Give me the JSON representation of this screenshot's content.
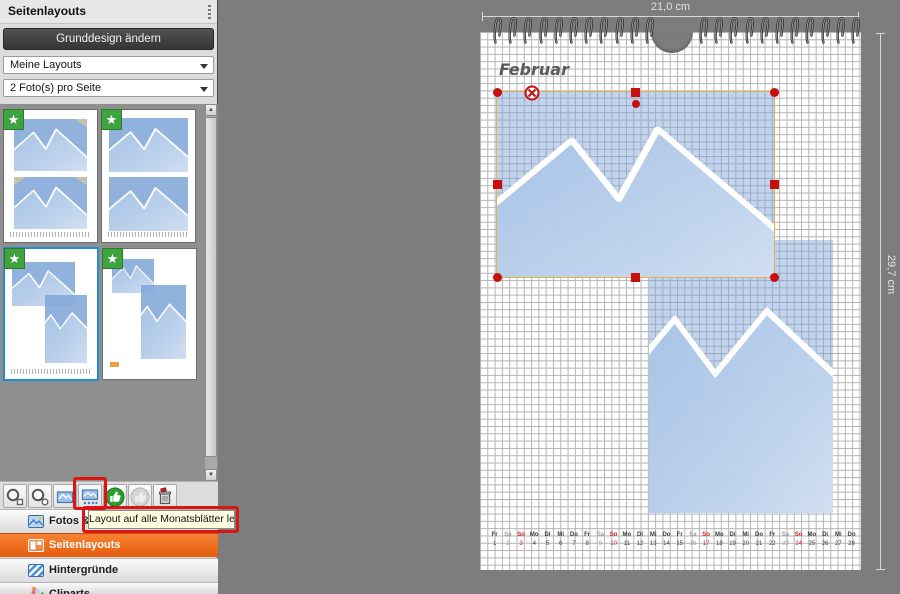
{
  "sidebar": {
    "title": "Seitenlayouts",
    "change_design_button": "Grunddesign ändern",
    "layout_group_value": "Meine Layouts",
    "photos_per_page_value": "2 Foto(s) pro Seite",
    "thumbnails": [
      {
        "name": "two-landscape-photos-with-corner-mounts",
        "starred": true,
        "selected": false
      },
      {
        "name": "two-landscape-photos-with-calendar",
        "starred": true,
        "selected": false
      },
      {
        "name": "landscape-and-portrait-overlap-with-calendar",
        "starred": true,
        "selected": true
      },
      {
        "name": "small-landscape-and-portrait",
        "starred": true,
        "selected": false
      }
    ],
    "nav": [
      {
        "label": "Fotos & Videos",
        "icon": "photo-icon",
        "active": false
      },
      {
        "label": "Seitenlayouts",
        "icon": "layout-icon",
        "active": true
      },
      {
        "label": "Hintergründe",
        "icon": "background-stripes-icon",
        "active": false
      },
      {
        "label": "Cliparts",
        "icon": "clipart-icon",
        "active": false
      }
    ]
  },
  "toolbar": {
    "tooltip": "Layout auf alle Monatsblätter legen",
    "buttons": [
      {
        "icon": "magnifier-box-icon"
      },
      {
        "icon": "magnifier-circle-icon"
      },
      {
        "icon": "photo-layout-icon"
      },
      {
        "icon": "photo-all-months-icon",
        "annotated": true
      },
      {
        "icon": "thumbs-up-green-icon"
      },
      {
        "icon": "thumbs-up-gray-icon"
      },
      {
        "icon": "trash-icon"
      }
    ]
  },
  "canvas": {
    "width_label": "21,0 cm",
    "height_label": "29,7 cm",
    "month_label": "Februar",
    "calendar": {
      "weekday_cycle": [
        "Fr",
        "Sa",
        "So",
        "Mo",
        "Di",
        "Mi",
        "Do"
      ],
      "days": [
        {
          "n": 1,
          "w": "Fr"
        },
        {
          "n": 2,
          "w": "Sa"
        },
        {
          "n": 3,
          "w": "So"
        },
        {
          "n": 4,
          "w": "Mo"
        },
        {
          "n": 5,
          "w": "Di"
        },
        {
          "n": 6,
          "w": "Mi"
        },
        {
          "n": 7,
          "w": "Do"
        },
        {
          "n": 8,
          "w": "Fr"
        },
        {
          "n": 9,
          "w": "Sa"
        },
        {
          "n": 10,
          "w": "So"
        },
        {
          "n": 11,
          "w": "Mo"
        },
        {
          "n": 12,
          "w": "Di"
        },
        {
          "n": 13,
          "w": "Mi"
        },
        {
          "n": 14,
          "w": "Do"
        },
        {
          "n": 15,
          "w": "Fr"
        },
        {
          "n": 16,
          "w": "Sa"
        },
        {
          "n": 17,
          "w": "So"
        },
        {
          "n": 18,
          "w": "Mo"
        },
        {
          "n": 19,
          "w": "Di"
        },
        {
          "n": 20,
          "w": "Mi"
        },
        {
          "n": 21,
          "w": "Do"
        },
        {
          "n": 22,
          "w": "Fr"
        },
        {
          "n": 23,
          "w": "Sa"
        },
        {
          "n": 24,
          "w": "So"
        },
        {
          "n": 25,
          "w": "Mo"
        },
        {
          "n": 26,
          "w": "Di"
        },
        {
          "n": 27,
          "w": "Mi"
        },
        {
          "n": 28,
          "w": "Do"
        }
      ]
    }
  },
  "colors": {
    "accent_orange": "#ee6418",
    "annotation_red": "#dd1414",
    "selection_border": "#e6b24b",
    "handle_red": "#c90e0e",
    "star_green": "#3fa33f",
    "photo_blue": "#a9c5e8",
    "sunday_red": "#cc2020",
    "saturday_gray": "#9b9b9b"
  }
}
